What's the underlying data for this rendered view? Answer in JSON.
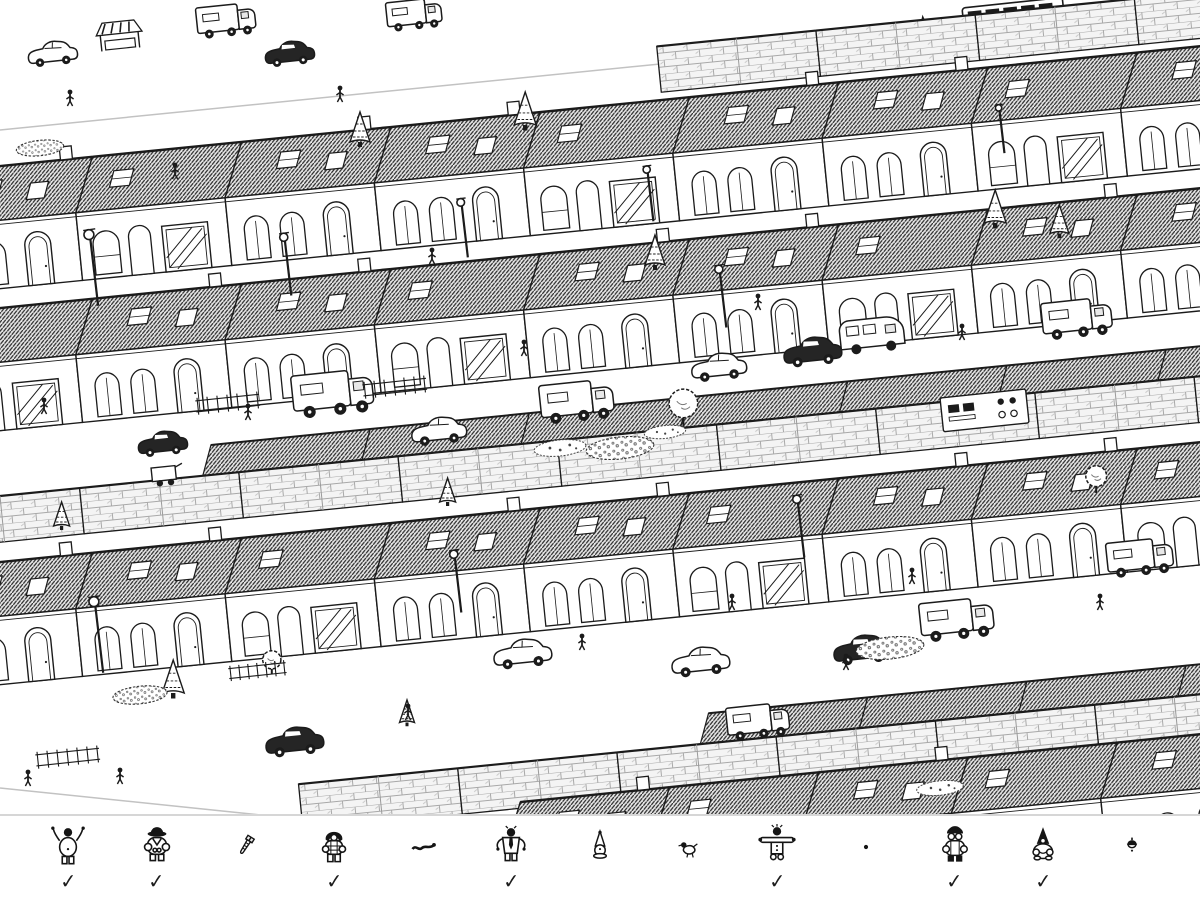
{
  "toolbar": {
    "found_check_glyph": "✓",
    "targets": [
      {
        "icon": "cheering-person-icon",
        "found": true
      },
      {
        "icon": "hat-person-icon",
        "found": true
      },
      {
        "icon": "screw-icon",
        "found": false
      },
      {
        "icon": "hooded-person-icon",
        "found": true
      },
      {
        "icon": "worm-icon",
        "found": false
      },
      {
        "icon": "tie-person-icon",
        "found": true
      },
      {
        "icon": "gnome-icon",
        "found": false
      },
      {
        "icon": "bird-icon",
        "found": false
      },
      {
        "icon": "arms-out-person-icon",
        "found": true
      },
      {
        "icon": "dot-icon",
        "found": false
      },
      {
        "icon": "glasses-person-icon",
        "found": true
      },
      {
        "icon": "pointed-hood-person-icon",
        "found": true
      },
      {
        "icon": "acorn-icon",
        "found": false
      }
    ]
  },
  "colors": {
    "background": "#ffffff",
    "ink": "#1b1b1b",
    "divider": "#d6d6d6",
    "roof_gray": "#555555",
    "wall_gray": "#f2f2f2"
  }
}
